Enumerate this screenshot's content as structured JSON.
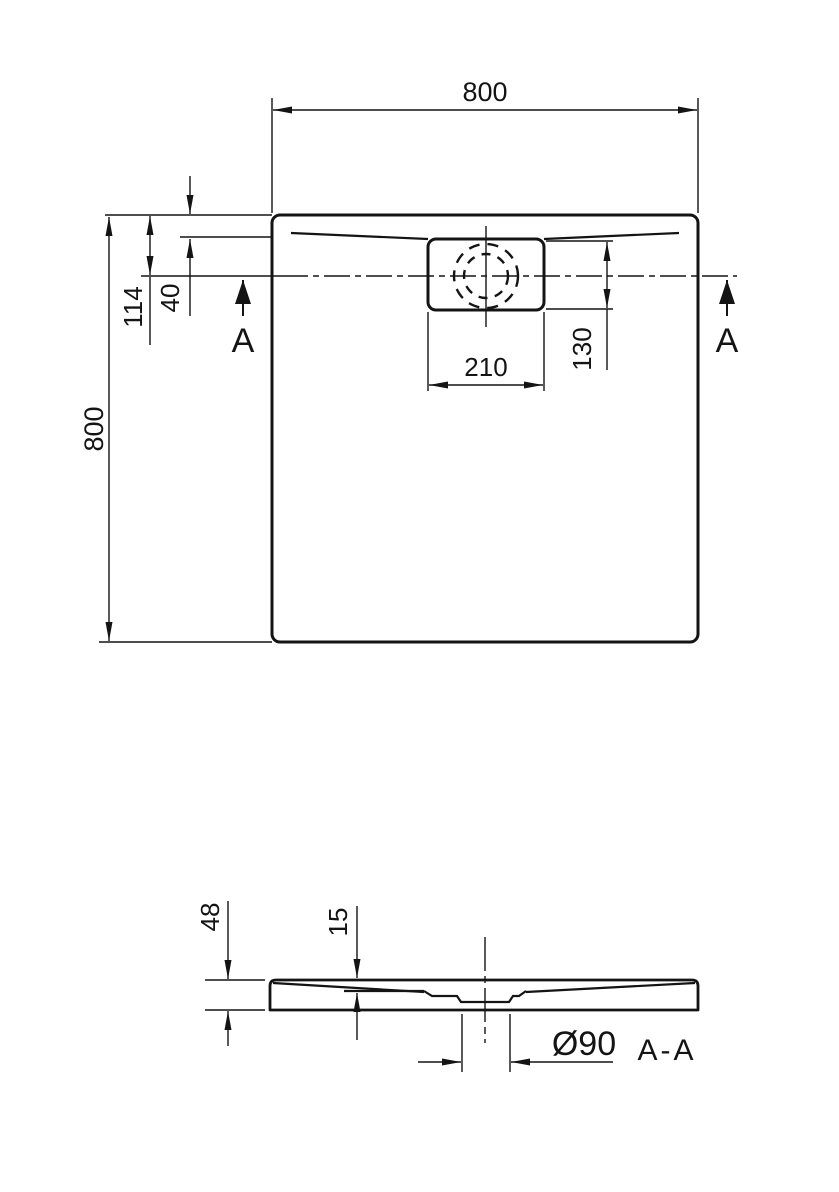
{
  "colors": {
    "line": "#141414",
    "background": "#ffffff"
  },
  "plan": {
    "dim_width_top": "800",
    "dim_height_left": "800",
    "dim_drain_center_from_top": "114",
    "dim_rim_inset": "40",
    "dim_drain_box_width": "210",
    "dim_drain_box_height": "130",
    "section_arrow_left": "A",
    "section_arrow_right": "A"
  },
  "section": {
    "label": "A-A",
    "dim_total_height": "48",
    "dim_basin_depth": "15",
    "dim_drain_diameter": "Ø90"
  }
}
